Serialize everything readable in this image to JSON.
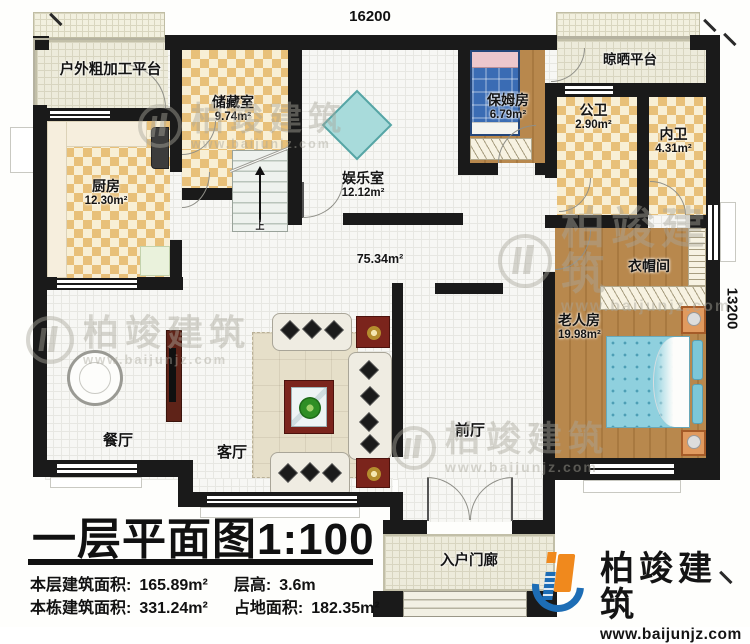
{
  "dimensions": {
    "top": "16200",
    "right": "13200"
  },
  "rooms": {
    "outdoor_platform": {
      "name": "户外粗加工平台"
    },
    "storage": {
      "name": "储藏室",
      "area": "9.74m²"
    },
    "entertainment": {
      "name": "娱乐室",
      "area": "12.12m²"
    },
    "nanny": {
      "name": "保姆房",
      "area": "6.79m²"
    },
    "drying_platform": {
      "name": "晾晒平台"
    },
    "public_bath": {
      "name": "公卫",
      "area": "2.90m²"
    },
    "inner_bath": {
      "name": "内卫",
      "area": "4.31m²"
    },
    "kitchen": {
      "name": "厨房",
      "area": "12.30m²"
    },
    "cloakroom": {
      "name": "衣帽间"
    },
    "elderly_room": {
      "name": "老人房",
      "area": "19.98m²"
    },
    "dining": {
      "name": "餐厅"
    },
    "living": {
      "name": "客厅"
    },
    "foyer": {
      "name": "前厅"
    },
    "porch": {
      "name": "入户门廊"
    },
    "hall_area": {
      "area": "75.34m²"
    }
  },
  "stairs": {
    "direction": "上"
  },
  "title_block": {
    "title": "一层平面图",
    "scale": "1:100"
  },
  "stats": {
    "floor_area_label": "本层建筑面积:",
    "floor_area_value": "165.89m²",
    "storey_height_label": "层高:",
    "storey_height_value": "3.6m",
    "building_area_label": "本栋建筑面积:",
    "building_area_value": "331.24m²",
    "footprint_label": "占地面积:",
    "footprint_value": "182.35m²"
  },
  "watermark": {
    "brand": "柏竣建筑",
    "url": "www.baijunjz.com"
  },
  "logo": {
    "brand": "柏竣建筑",
    "url": "www.baijunjz.com"
  },
  "colors": {
    "wall": "#1a1a1a",
    "checker": "#e8c079",
    "cream": "#f8efd5",
    "wood": "#b5874a",
    "bed_blue": "#3a6cb4",
    "bed_cyan": "#8fd0de",
    "table_teal": "#a8dbdb",
    "logo_blue": "#1d6db5",
    "logo_orange": "#f0891d"
  }
}
